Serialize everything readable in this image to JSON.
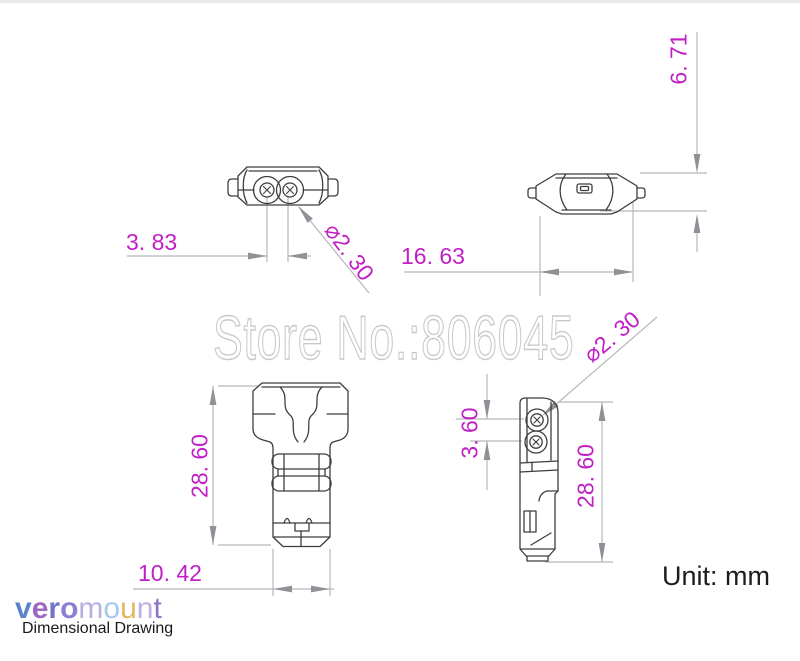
{
  "watermark": "Store No.:806045",
  "unit": {
    "label": "Unit: mm"
  },
  "dims": {
    "front_pin_spacing": "3. 83",
    "front_pin_diameter": "⌀2. 30",
    "top_height": "6. 71",
    "top_width": "16. 63",
    "front_height": "28. 60",
    "front_width": "10. 42",
    "side_hole_spacing": "3. 60",
    "side_height": "28. 60",
    "side_hole_diameter": "⌀2. 30"
  },
  "brand": {
    "name": "veromount",
    "subtitle": "Dimensional Drawing",
    "letters": [
      {
        "char": "v",
        "style": "color:#5b83c8;font-weight:bold"
      },
      {
        "char": "e",
        "style": "color:#9c68c0;font-weight:bold"
      },
      {
        "char": "r",
        "style": "color:#6f74c8;font-weight:bold"
      },
      {
        "char": "o",
        "style": "color:#8f7fd0;font-weight:bold"
      },
      {
        "char": "m",
        "style": "color:#b8b0e0"
      },
      {
        "char": "o",
        "style": "color:#a6c8ec"
      },
      {
        "char": "u",
        "style": "color:#e5b65f"
      },
      {
        "char": "n",
        "style": "color:#beb0e2"
      },
      {
        "char": "t",
        "style": "color:#8a74c6"
      }
    ]
  },
  "colors": {
    "dimension_text": "#c01fc5",
    "part_outline": "#3e3e3e",
    "dimension_line": "#b5b8bc",
    "arrow": "#8e9297",
    "watermark_stroke": "#c9c9c9"
  }
}
